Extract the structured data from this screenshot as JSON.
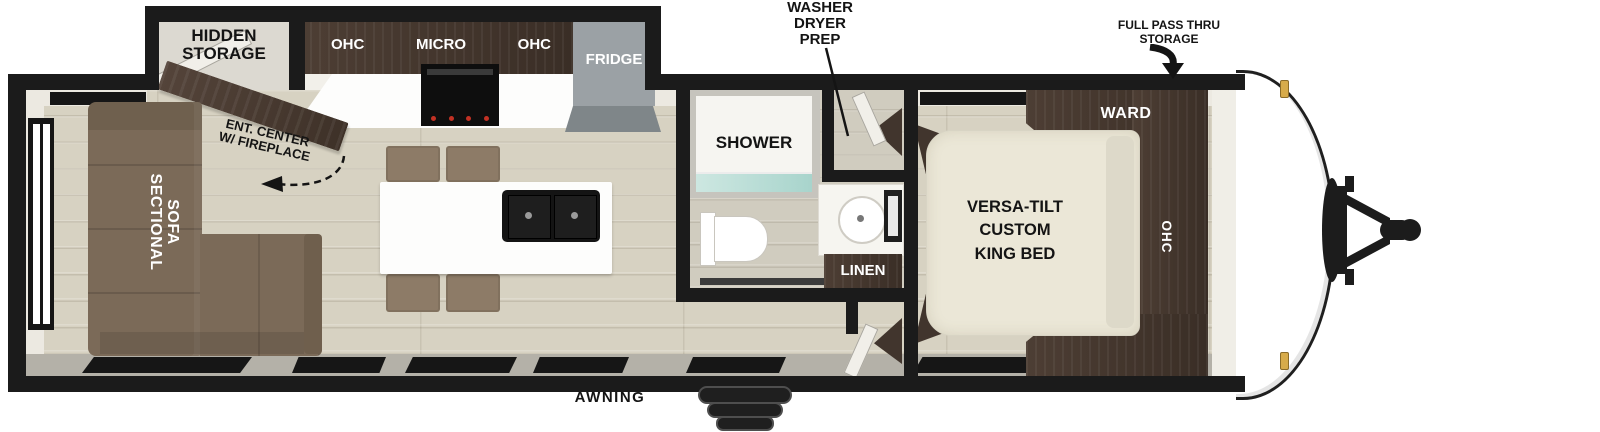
{
  "title": "Travel trailer floor plan",
  "colors": {
    "wall": "#1b1b1b",
    "floor_wood": "#d7d2c2",
    "cabinet_walnut": "#46372e",
    "sofa_brown": "#7b6a58",
    "chair_brown": "#8d7b67",
    "fridge_gray": "#9ba1a5",
    "bed_cream": "#ebe7d7",
    "shower_glass": "#b9ded8",
    "clearance_light_gold": "#d7ab4a"
  },
  "exterior": {
    "washer_prep": {
      "l1": "WASHER",
      "l2": "DRYER",
      "l3": "PREP"
    },
    "full_pass": {
      "l1": "FULL PASS THRU",
      "l2": "STORAGE"
    },
    "awning": "AWNING"
  },
  "kitchen": {
    "hidden_storage": {
      "l1": "HIDDEN",
      "l2": "STORAGE"
    },
    "cabinet": {
      "ohc_left": "OHC",
      "micro": "MICRO",
      "ohc_right": "OHC"
    },
    "fridge": "FRIDGE",
    "ent_center": {
      "l1": "ENT. CENTER",
      "l2": "W/ FIREPLACE"
    }
  },
  "living": {
    "sofa": {
      "l1": "SECTIONAL",
      "l2": "SOFA"
    }
  },
  "bath": {
    "shower": "SHOWER",
    "linen": "LINEN"
  },
  "bedroom": {
    "bed": {
      "l1": "VERSA-TILT",
      "l2": "CUSTOM",
      "l3": "KING BED"
    },
    "ward": "WARD",
    "ohc": "OHC"
  }
}
